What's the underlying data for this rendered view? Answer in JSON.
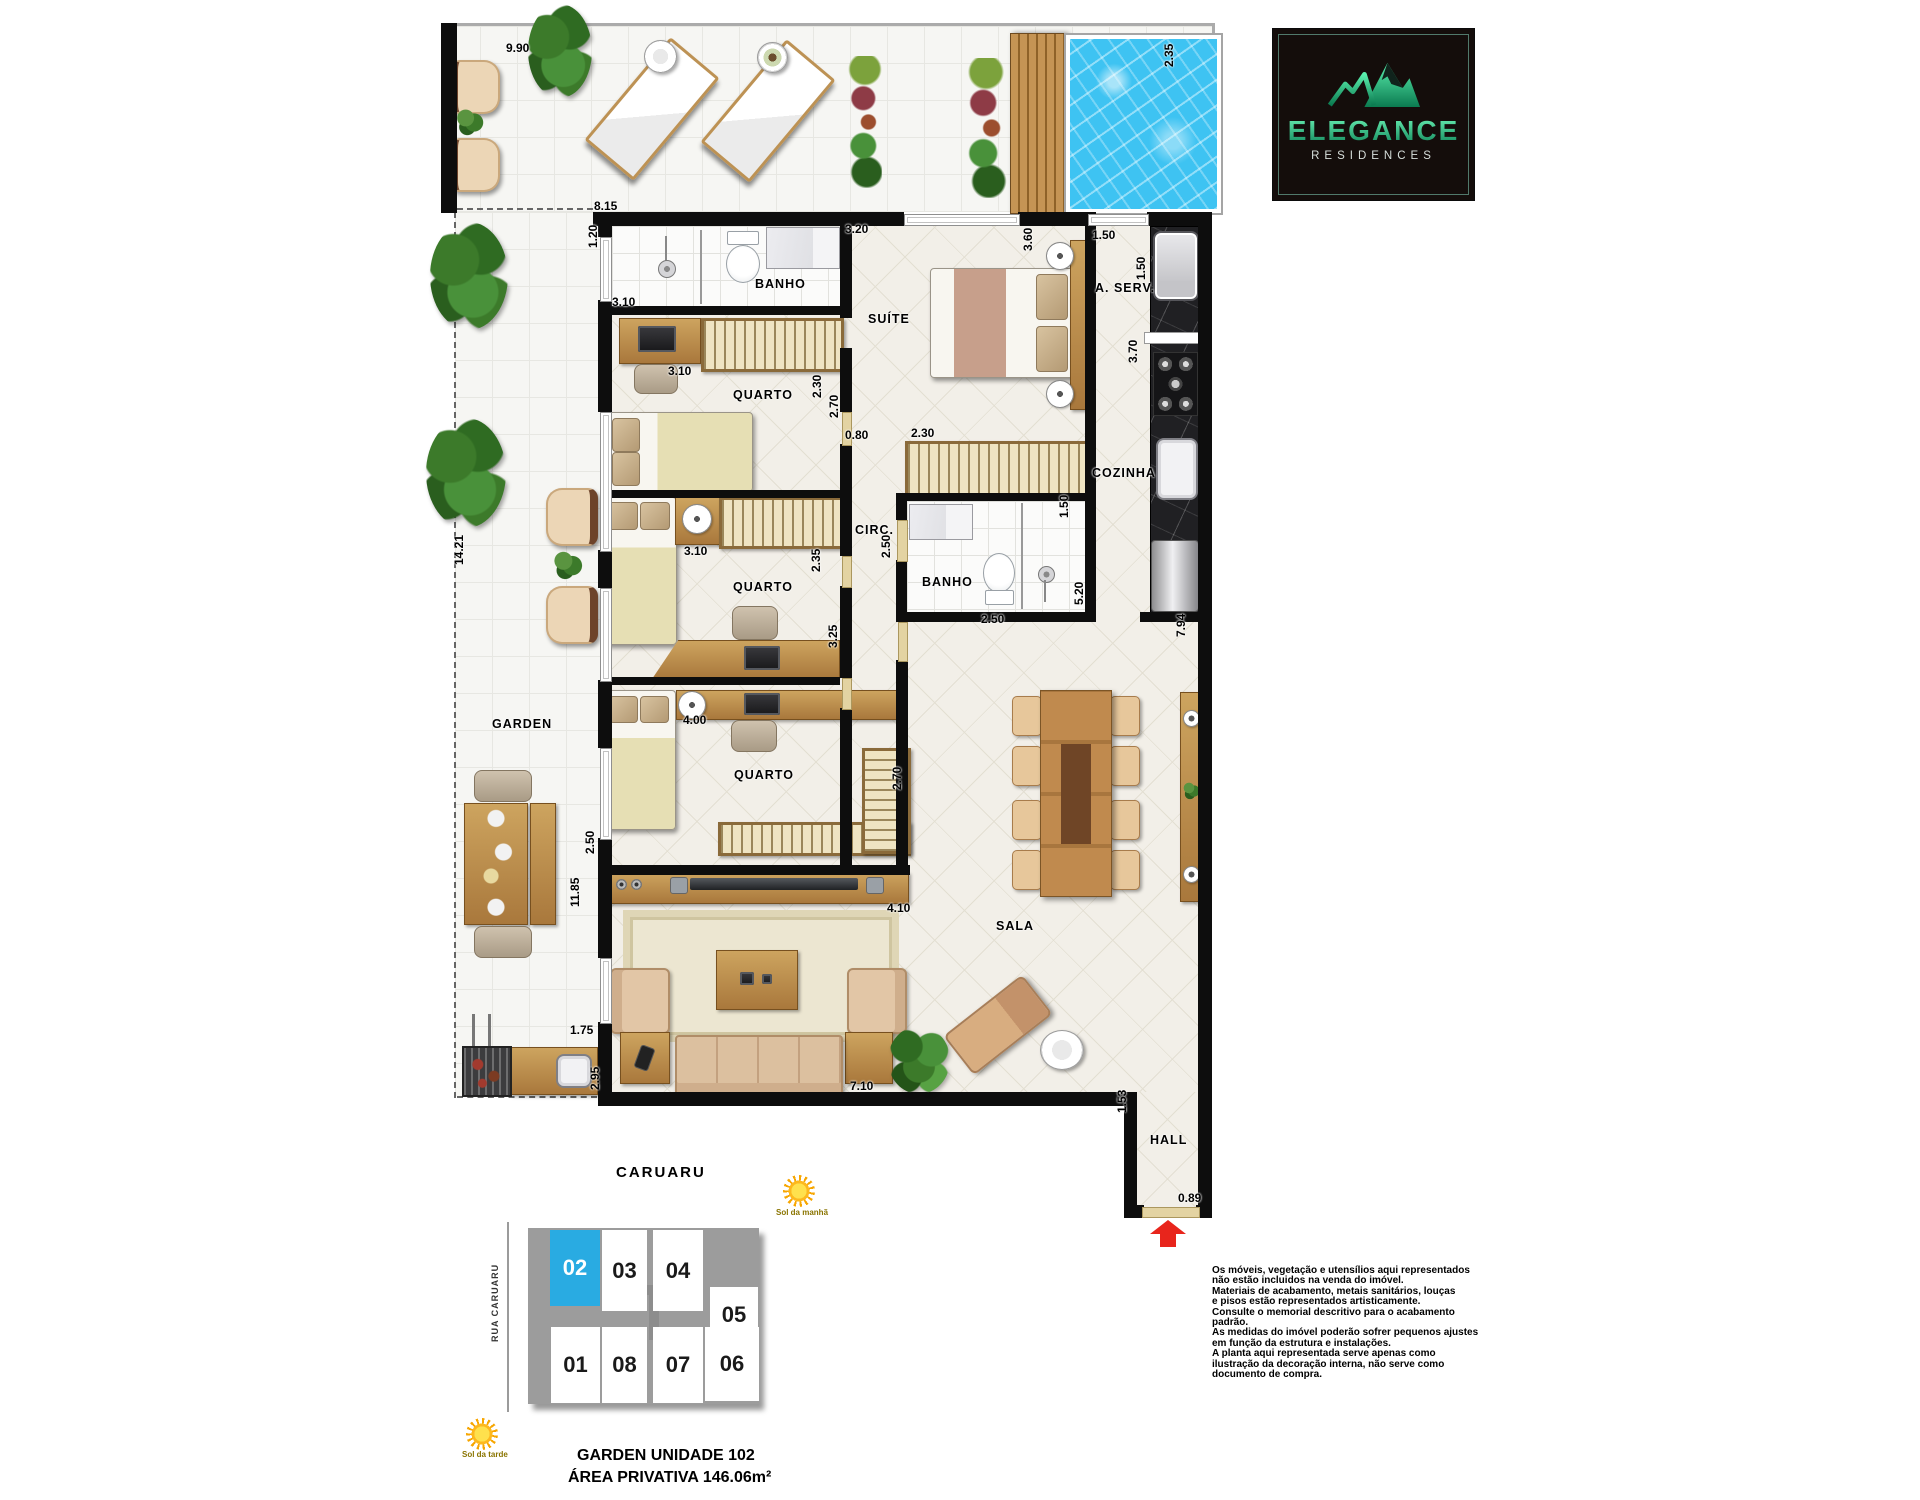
{
  "logo": {
    "name": "ELEGANCE",
    "tagline": "RESIDENCES"
  },
  "plan": {
    "dimensions": [
      {
        "t": "9.90",
        "x": 506,
        "y": 42
      },
      {
        "t": "2.35",
        "x": 1176,
        "y": 54,
        "v": 1
      },
      {
        "t": "8.15",
        "x": 594,
        "y": 200
      },
      {
        "t": "3.20",
        "x": 845,
        "y": 223
      },
      {
        "t": "1.50",
        "x": 1092,
        "y": 229
      },
      {
        "t": "1.20",
        "x": 600,
        "y": 235,
        "v": 1
      },
      {
        "t": "3.60",
        "x": 1035,
        "y": 238,
        "v": 1
      },
      {
        "t": "1.50",
        "x": 1148,
        "y": 267,
        "v": 1
      },
      {
        "t": "3.10",
        "x": 612,
        "y": 296
      },
      {
        "t": "3.70",
        "x": 1140,
        "y": 350,
        "v": 1
      },
      {
        "t": "3.10",
        "x": 668,
        "y": 365
      },
      {
        "t": "2.30",
        "x": 824,
        "y": 385,
        "v": 1
      },
      {
        "t": "2.70",
        "x": 841,
        "y": 405,
        "v": 1
      },
      {
        "t": "0.80",
        "x": 845,
        "y": 429
      },
      {
        "t": "2.30",
        "x": 911,
        "y": 427
      },
      {
        "t": "1.50",
        "x": 1071,
        "y": 505,
        "v": 1
      },
      {
        "t": "2.50",
        "x": 893,
        "y": 545,
        "v": 1
      },
      {
        "t": "3.10",
        "x": 684,
        "y": 545
      },
      {
        "t": "2.35",
        "x": 823,
        "y": 559,
        "v": 1
      },
      {
        "t": "14.21",
        "x": 466,
        "y": 552,
        "v": 1
      },
      {
        "t": "5.20",
        "x": 1086,
        "y": 592,
        "v": 1
      },
      {
        "t": "2.50",
        "x": 981,
        "y": 613
      },
      {
        "t": "7.94",
        "x": 1188,
        "y": 624,
        "v": 1
      },
      {
        "t": "3.25",
        "x": 840,
        "y": 635,
        "v": 1
      },
      {
        "t": "4.00",
        "x": 683,
        "y": 714
      },
      {
        "t": "2.70",
        "x": 904,
        "y": 777,
        "v": 1
      },
      {
        "t": "2.50",
        "x": 597,
        "y": 841,
        "v": 1
      },
      {
        "t": "11.85",
        "x": 582,
        "y": 894,
        "v": 1
      },
      {
        "t": "4.10",
        "x": 887,
        "y": 902
      },
      {
        "t": "1.75",
        "x": 570,
        "y": 1024
      },
      {
        "t": "2.95",
        "x": 602,
        "y": 1077,
        "v": 1
      },
      {
        "t": "7.10",
        "x": 850,
        "y": 1080
      },
      {
        "t": "1.53",
        "x": 1129,
        "y": 1100,
        "v": 1
      },
      {
        "t": "0.89",
        "x": 1178,
        "y": 1192
      }
    ],
    "rooms": [
      {
        "t": "BANHO",
        "x": 755,
        "y": 277
      },
      {
        "t": "SUÍTE",
        "x": 868,
        "y": 312
      },
      {
        "t": "A. SERV.",
        "x": 1095,
        "y": 281
      },
      {
        "t": "QUARTO",
        "x": 733,
        "y": 388
      },
      {
        "t": "COZINHA",
        "x": 1092,
        "y": 466
      },
      {
        "t": "CIRC.",
        "x": 855,
        "y": 523
      },
      {
        "t": "BANHO",
        "x": 922,
        "y": 575
      },
      {
        "t": "QUARTO",
        "x": 733,
        "y": 580
      },
      {
        "t": "GARDEN",
        "x": 492,
        "y": 717
      },
      {
        "t": "QUARTO",
        "x": 734,
        "y": 768
      },
      {
        "t": "SALA",
        "x": 996,
        "y": 919
      },
      {
        "t": "HALL",
        "x": 1150,
        "y": 1133
      }
    ]
  },
  "location": {
    "heading": "CARUARU",
    "street": "RUA CARUARU",
    "sun_morning": "Sol da manhã",
    "sun_afternoon": "Sol da tarde",
    "units": [
      {
        "n": "02",
        "x": 22,
        "y": 2,
        "w": 50,
        "h": 76,
        "hl": true
      },
      {
        "n": "03",
        "x": 74,
        "y": 2,
        "w": 45,
        "h": 81
      },
      {
        "n": "04",
        "x": 125,
        "y": 2,
        "w": 50,
        "h": 81
      },
      {
        "n": "05",
        "x": 182,
        "y": 59,
        "w": 48,
        "h": 55
      },
      {
        "n": "01",
        "x": 23,
        "y": 99,
        "w": 49,
        "h": 76
      },
      {
        "n": "08",
        "x": 74,
        "y": 99,
        "w": 45,
        "h": 76
      },
      {
        "n": "07",
        "x": 125,
        "y": 99,
        "w": 50,
        "h": 76
      },
      {
        "n": "06",
        "x": 177,
        "y": 99,
        "w": 54,
        "h": 74
      }
    ]
  },
  "unit_info": {
    "line1": "GARDEN UNIDADE 102",
    "line2": "ÁREA PRIVATIVA 146.06m²"
  },
  "disclaimer": {
    "lines": [
      "Os móveis, vegetação e utensílios aqui representados",
      "não estão incluidos na venda do imóvel.",
      "Materiais de acabamento, metais sanitários, louças",
      "e pisos estão representados artisticamente.",
      "Consulte o memorial descritivo para o acabamento",
      "padrão.",
      "As medidas do imóvel poderão sofrer pequenos ajustes",
      "em função da estrutura e instalações.",
      "A planta aqui representada serve apenas como",
      "ilustração da decoração interna, não serve como",
      "documento de compra."
    ]
  },
  "colors": {
    "unit_highlight": "#29abe2",
    "entry_arrow": "#e8251c",
    "pool_water": "#3ec3f2",
    "logo_green": "#2fd496",
    "wall": "#0d0d0d"
  }
}
